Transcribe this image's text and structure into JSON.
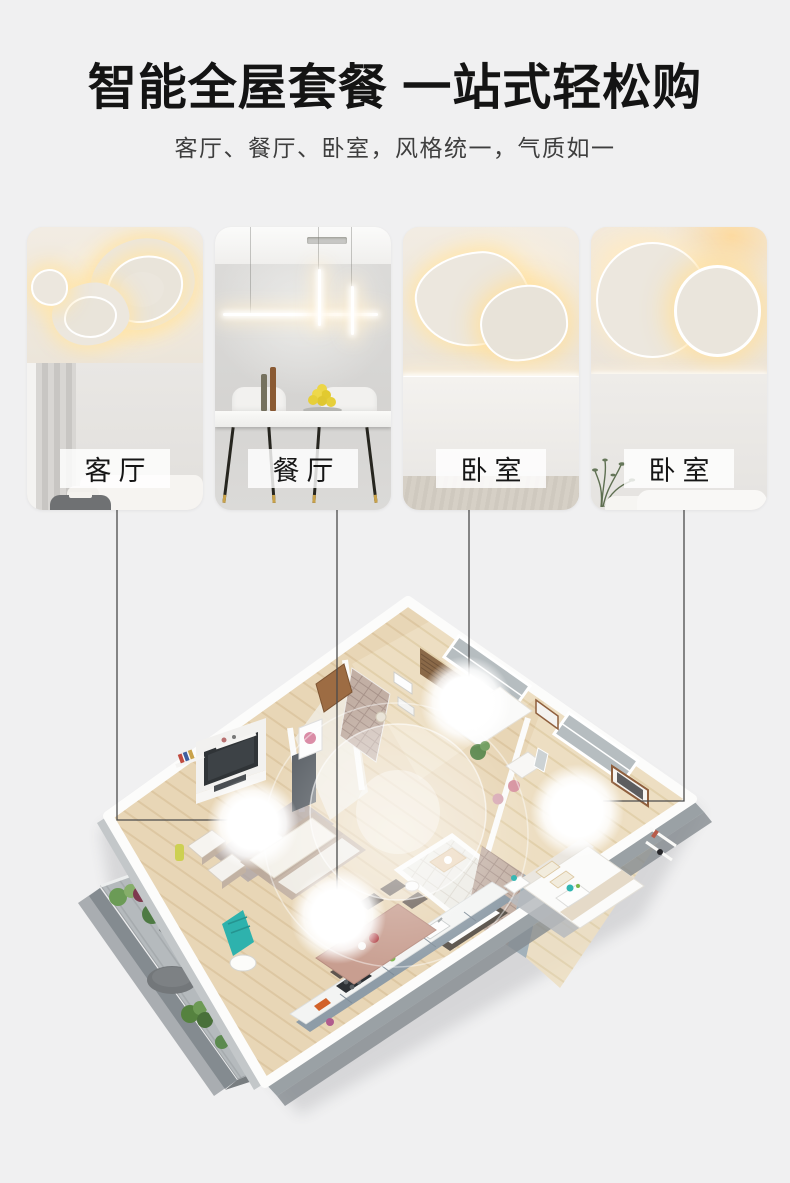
{
  "header": {
    "title": "智能全屋套餐 一站式轻松购",
    "subtitle": "客厅、餐厅、卧室，风格统一，气质如一"
  },
  "cards": [
    {
      "label": "客厅",
      "scene": "organic-blob-ceiling-light"
    },
    {
      "label": "餐厅",
      "scene": "linear-pendant-light"
    },
    {
      "label": "卧室",
      "scene": "triangle-panel-ceiling-light"
    },
    {
      "label": "卧室",
      "scene": "round-panel-ceiling-light"
    }
  ],
  "floorplan": {
    "lights": [
      "living-room-light",
      "dining-room-light",
      "bedroom-2-light",
      "bedroom-1-light"
    ]
  },
  "colors": {
    "page_background": "#f0f0f1",
    "title_text": "#141414",
    "subtitle_text": "#3e3e3e",
    "label_background": "rgba(255,255,255,0.82)",
    "label_text": "#161616",
    "connector_line": "#4b4b4b",
    "warm_glow": "#ffe5aa"
  }
}
